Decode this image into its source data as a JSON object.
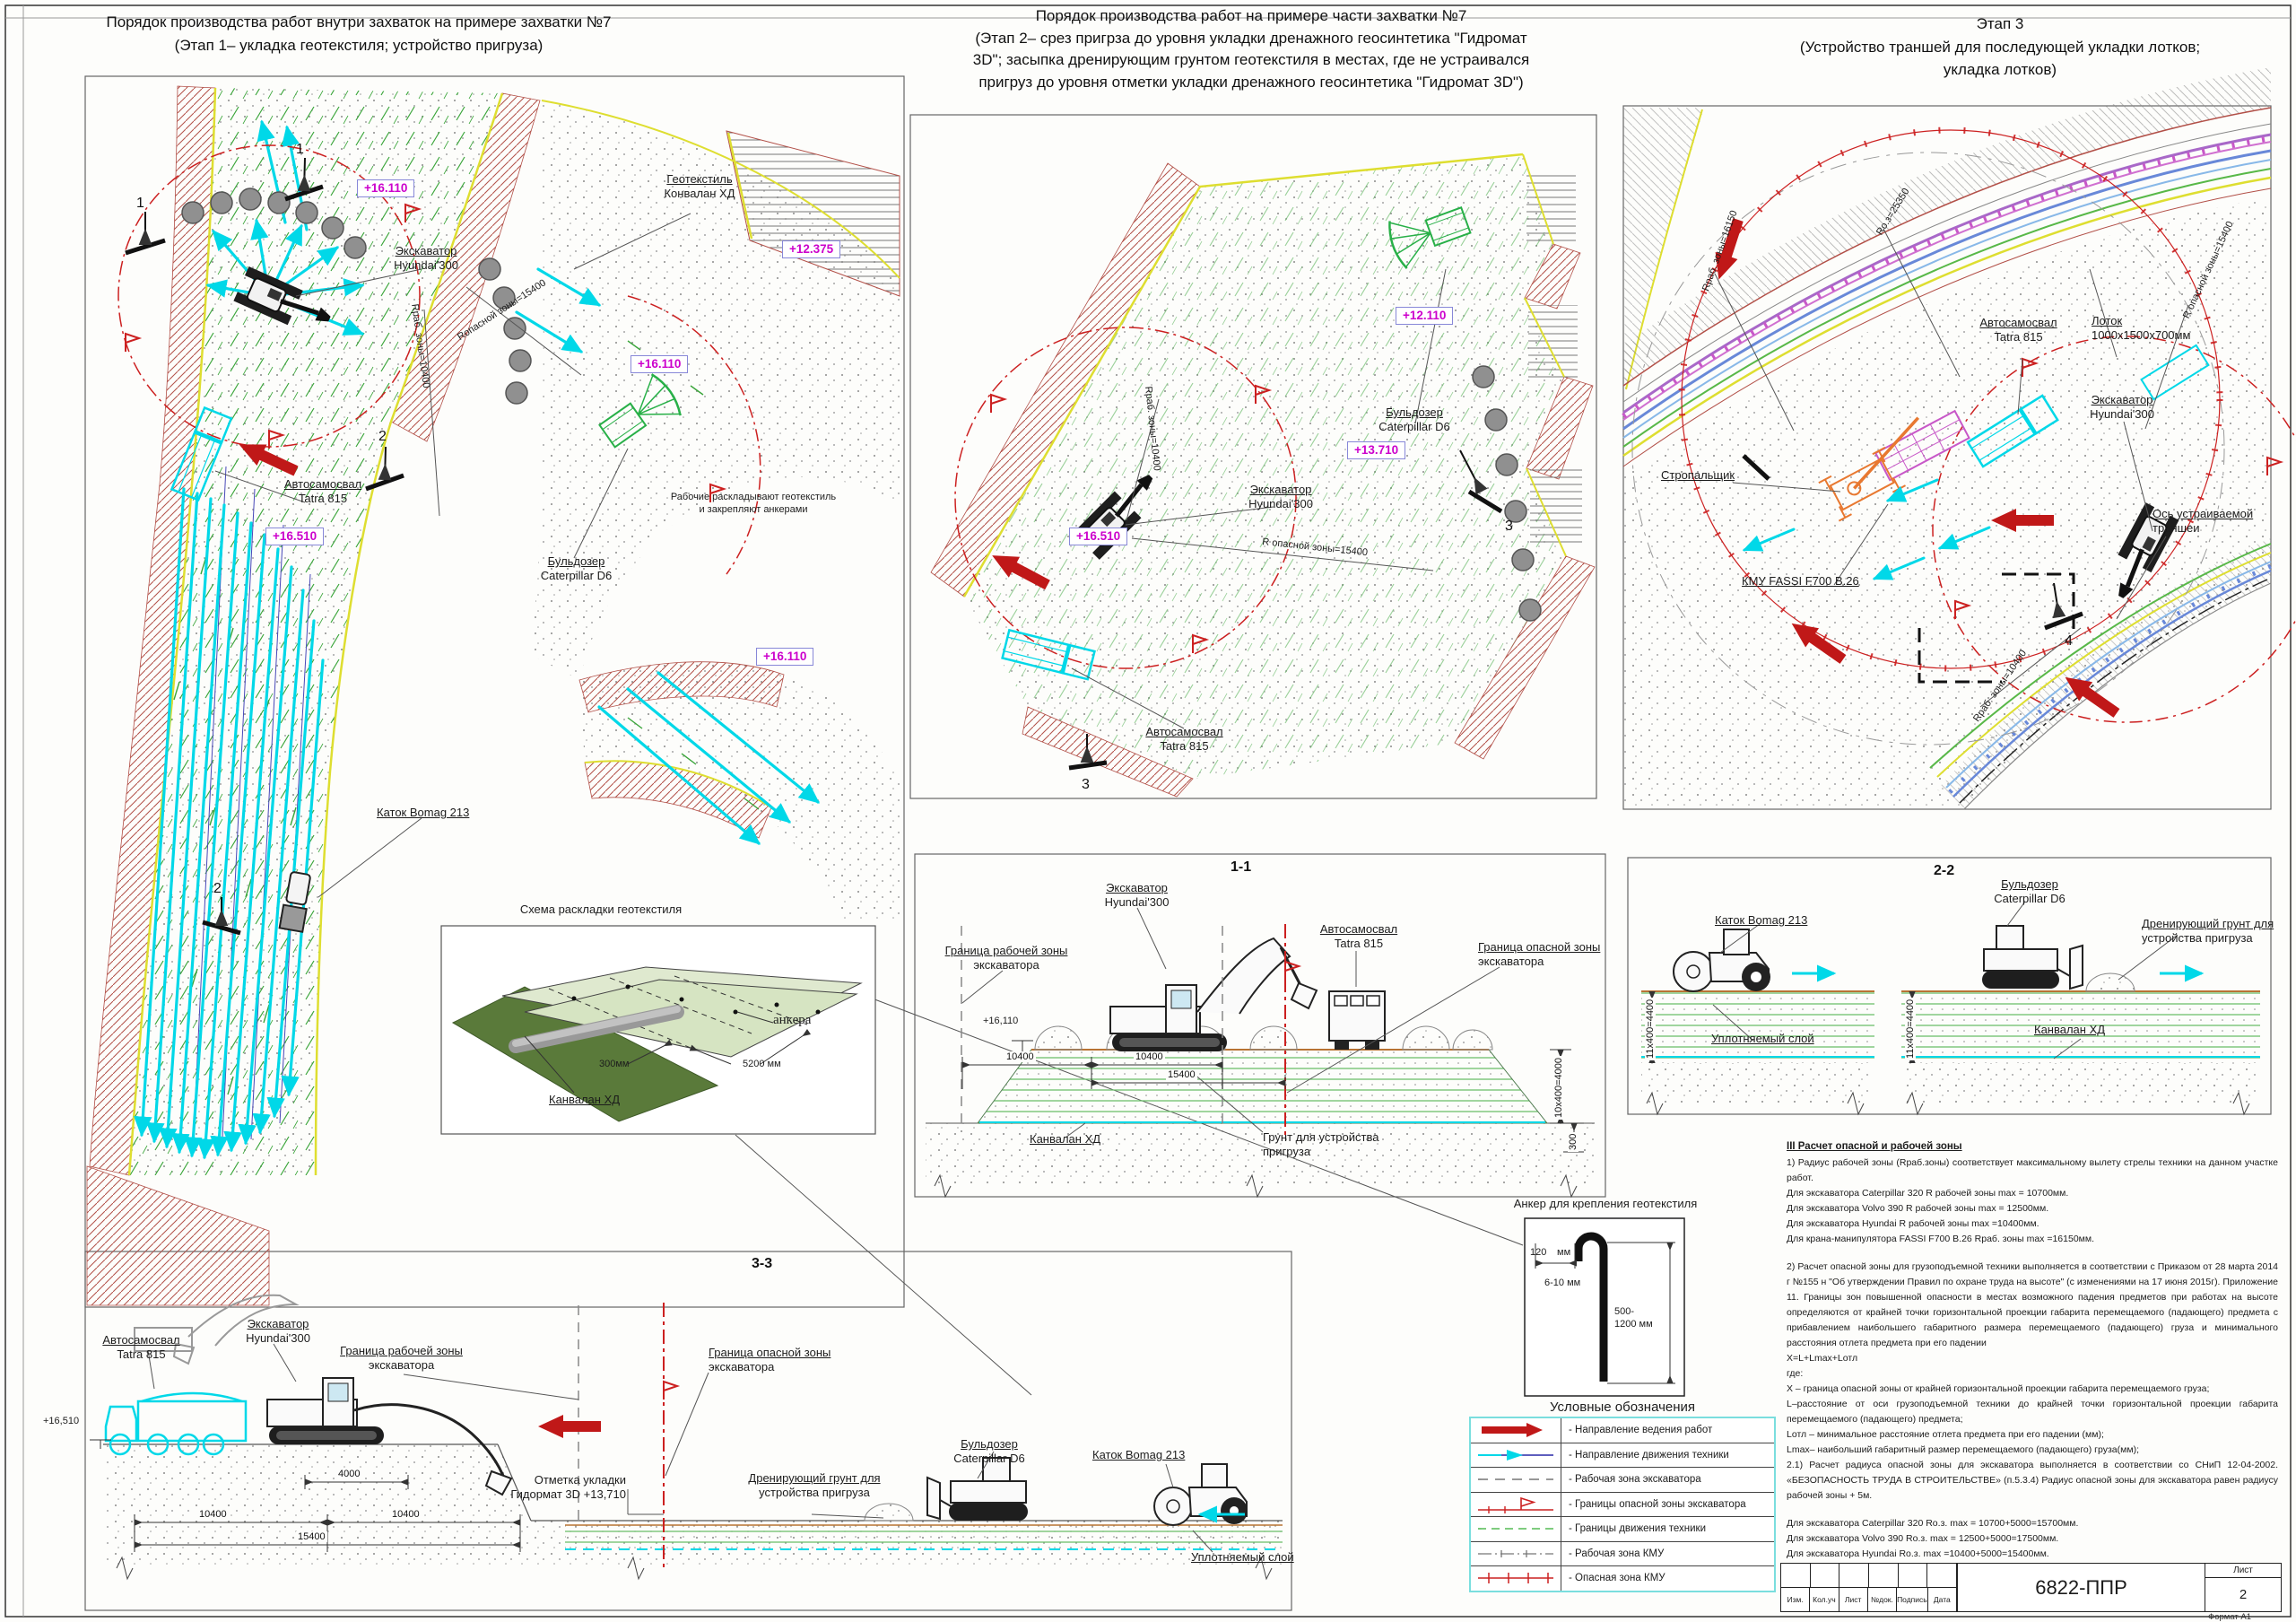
{
  "sheet": {
    "code": "6822-ППР",
    "sheet_label": "Лист",
    "sheet_number": "2",
    "format": "Формат А1",
    "tb": {
      "c1": "Изм.",
      "c2": "Кол.уч",
      "c3": "Лист",
      "c4": "№док.",
      "c5": "Подпись",
      "c6": "Дата"
    }
  },
  "titles": {
    "p1l1": "Порядок производства работ внутри захваток на примере захватки №7",
    "p1l2": "(Этап 1– укладка геотекстиля; устройство пригруза)",
    "p2l1": "Порядок производства работ  на примере части захватки №7",
    "p2l2": "(Этап 2– срез пригрза до уровня укладки дренажного геосинтетика \"Гидромат",
    "p2l3": "3D\"; засыпка дренирующим грунтом геотекстиля в местах, где не устраивался",
    "p2l4": "пригруз до уровня отметки укладки дренажного геосинтетика \"Гидромат 3D\")",
    "p3l1": "Этап 3",
    "p3l2": "(Устройство траншей для последующей укладки  лотков;",
    "p3l3": "укладка лотков)"
  },
  "plan1": {
    "elev_16110": "+16.110",
    "elev_12375": "+12.375",
    "elev_16510": "+16.510",
    "geotextile": "Геотекстиль",
    "geotextile2": "Конвалан ХД",
    "excavator": "Экскаватор",
    "excavator2": "Hyundai'300",
    "truck": "Автосамосвал",
    "truck2": "Tatra 815",
    "dozer": "Бульдозер",
    "dozer2": "Caterpillar D6",
    "workers": "Рабочие раскладывают геотекстиль",
    "workers2": "и закрепляют анкерами",
    "roller": "Каток Bomag 213",
    "r_work": "Rраб. зоны=10400",
    "r_danger": "Rопасной зоны=15400",
    "m1": "1",
    "m2": "2"
  },
  "inset": {
    "title": "Схема раскладки геотекстиля",
    "anchors": "анкера",
    "d300": "300мм",
    "d5200": "5200 мм",
    "kanvalan": "Канвалан ХД"
  },
  "plan2": {
    "elev_12110": "+12.110",
    "elev_13710": "+13.710",
    "elev_16510": "+16.510",
    "excavator": "Экскаватор",
    "excavator2": "Hyundai'300",
    "dozer": "Бульдозер",
    "dozer2": "Caterpillar D6",
    "truck": "Автосамосвал",
    "truck2": "Tatra 815",
    "r_work": "Rраб. зоны=10400",
    "r_danger": "R опасной зоны=15400",
    "m3": "3"
  },
  "plan3": {
    "truck": "Автосамосвал",
    "truck2": "Tatra 815",
    "lotok": "Лоток",
    "lotok2": "1000х1500х700мм",
    "excavator": "Экскаватор",
    "excavator2": "Hyundai'300",
    "axis": "Ось устраиваемой",
    "axis2": "траншеи",
    "slinger": "Стропальщик",
    "kmu": "КМУ FASSI F700 B.26",
    "r_oz": "Rо.з=25350",
    "r16150": "Rраб. зоны=16150",
    "r10400": "Rраб. зоны=10400",
    "r15400": "R опасной зоны=15400",
    "m4": "4"
  },
  "s11": {
    "title": "1-1",
    "excavator": "Экскаватор",
    "excavator2": "Hyundai'300",
    "truck": "Автосамосвал",
    "truck2": "Tatra 815",
    "border_work": "Граница рабочей зоны",
    "border_work2": "экскаватора",
    "border_danger": "Граница опасной зоны",
    "border_danger2": "экскаватора",
    "elev": "+16,110",
    "d10400": "10400",
    "d15400": "15400",
    "dv": "10х400=4000",
    "d300": "300",
    "kanvalan": "Канвалан ХД",
    "prigruz": "Грунт для устройства",
    "prigruz2": "пригруза"
  },
  "s22": {
    "title": "2-2",
    "roller": "Каток Bomag 213",
    "dozer": "Бульдозер",
    "dozer2": "Caterpillar D6",
    "drain": "Дренирующий грунт для",
    "drain2": "устройства пригруза",
    "layer": "Уплотняемый слой",
    "kanvalan": "Канвалан ХД",
    "dv": "11х400=4400"
  },
  "s33": {
    "title": "3-3",
    "truck": "Автосамосвал",
    "truck2": "Tatra 815",
    "excavator": "Экскаватор",
    "excavator2": "Hyundai'300",
    "border_work": "Граница рабочей зоны",
    "border_work2": "экскаватора",
    "border_danger": "Граница опасной зоны",
    "border_danger2": "экскаватора",
    "mark": "Отметка укладки",
    "mark2": "Гидормат 3D  +13,710",
    "drain": "Дренирующий грунт для",
    "drain2": "устройства пригруза",
    "dozer": "Бульдозер",
    "dozer2": "Caterpillar D6",
    "roller": "Каток Bomag 213",
    "layer": "Уплотняемый слой",
    "elev": "+16,510",
    "d4000": "4000",
    "d10400": "10400",
    "d15400": "15400"
  },
  "anchor": {
    "title": "Анкер для крепления геотекстиля",
    "d120": "120",
    "mm": "мм",
    "d610": "6-10 мм",
    "d500": "500-",
    "d1200": "1200 мм"
  },
  "legend": {
    "title": "Условные обозначения",
    "i1": "- Направление ведения работ",
    "i2": "- Направление движения техники",
    "i3": "- Рабочая зона экскаватора",
    "i4": "- Границы опасной зоны экскаватора",
    "i5": "- Границы движения техники",
    "i6": "- Рабочая зона КМУ",
    "i7": "- Опасная зона КМУ"
  },
  "notes": {
    "heading": "III Расчет опасной и рабочей зоны",
    "l1": "1) Радиус рабочей зоны (Rраб.зоны) соответствует максимальному вылету стрелы техники на данном участке работ.",
    "l2": "Для экскаватора Caterpillar 320 R рабочей зоны  max = 10700мм.",
    "l3": "Для экскаватора Volvo 390 R рабочей зоны  max = 12500мм.",
    "l4": "Для экскаватора Hyundai R рабочей зоны  max =10400мм.",
    "l5": "Для крана-манипулятора FASSI F700 B.26   Rраб. зоны max =16150мм.",
    "l6": "2) Расчет опасной зоны для грузоподъемной техники выполняется в соответствии с Приказом от 28 марта 2014 г №155 н \"Об утверждении Правил по охране труда на высоте\" (с изменениями на 17 июня 2015г). Приложение 11. Границы зон повышенной опасности в местах возможного падения предметов при работах на высоте определяются от крайней точки горизонтальной проекции габарита перемещаемого (падающего) предмета с прибавлением наибольшего габаритного размера перемещаемого (падающего) груза и минимального расстояния отлета предмета при его падении",
    "l7": "X=L+Lmax+Lотл",
    "l8": "где:",
    "l9": "X – граница опасной зоны от крайней горизонтальной проекции габарита перемещаемого груза;",
    "l10": "L–расстояние от оси грузоподъемной техники до крайней точки горизонтальной проекции габарита перемещаемого (падающего) предмета;",
    "l11": "Lотл – минимальное расстояние отлета предмета при его падении (мм);",
    "l12": "Lmax– наибольший габаритный размер перемещаемого (падающего) груза(мм);",
    "l13": "2.1) Расчет радиуса опасной зоны для экскаватора выполняется в соответствии со СНиП 12-04-2002. «БЕЗОПАСНОСТЬ ТРУДА В СТРОИТЕЛЬСТВЕ» (п.5.3.4) Радиус опасной зоны для экскаватора равен радиусу рабочей зоны + 5м.",
    "l14": "Для экскаватора Caterpillar 320 Rо.з.  max  = 10700+5000=15700мм.",
    "l15": "Для экскаватора Volvo 390 Rо.з.  max  = 12500+5000=17500мм.",
    "l16": "Для экскаватора Hyundai Rо.з.  max  =10400+5000=15400мм.",
    "l17": "Для крана-манипулятора FASSI F700 B.26 Rо.з.   max  =16150+4000+5200=25350мм"
  }
}
